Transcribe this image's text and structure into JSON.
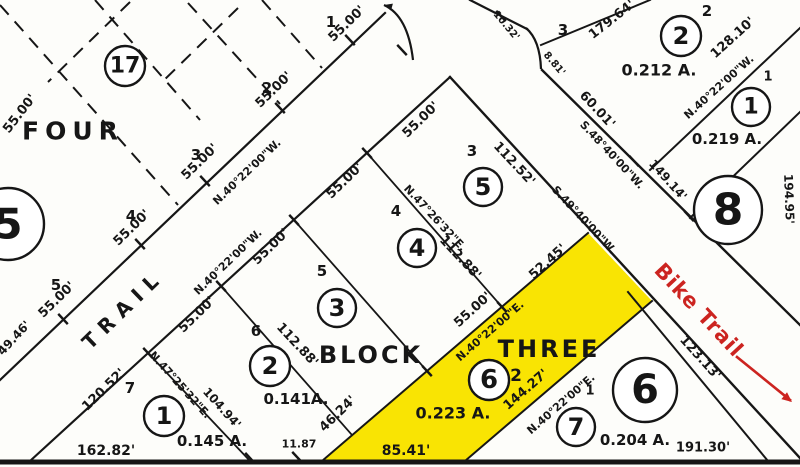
{
  "document": {
    "type": "plat-survey-map",
    "highlighted_parcel": "Lot 2 Block THREE (0.223 A.)"
  },
  "colors": {
    "ink": "#161616",
    "background": "#fdfdfa",
    "highlight_yellow": "#f9e403",
    "annotation_red": "#cc2420"
  },
  "map": {
    "labels": [
      {
        "text": "FOUR",
        "x": 73,
        "y": 131,
        "rot": 0,
        "size": 25,
        "spacing": 6,
        "name": "block-four-title"
      },
      {
        "text": "BLOCK",
        "x": 371,
        "y": 355,
        "rot": 0,
        "size": 24,
        "spacing": 3,
        "name": "block-three-title-block"
      },
      {
        "text": "THREE",
        "x": 549,
        "y": 349,
        "rot": 0,
        "size": 24,
        "spacing": 3,
        "name": "block-three-title-three"
      },
      {
        "text": "TRAIL",
        "x": 123,
        "y": 309,
        "rot": -44,
        "size": 20,
        "spacing": 8,
        "name": "trail-road-label"
      },
      {
        "text": "Bike Trail",
        "x": 699,
        "y": 310,
        "rot": 47,
        "size": 21,
        "spacing": 1,
        "color": "#cc2420",
        "name": "bike-trail-label"
      },
      {
        "text": "0.212 A.",
        "x": 659,
        "y": 70,
        "rot": 0,
        "size": 16
      },
      {
        "text": "0.219 A.",
        "x": 727,
        "y": 139,
        "rot": 0,
        "size": 15
      },
      {
        "text": "0.141A.",
        "x": 296,
        "y": 399,
        "rot": 0,
        "size": 15
      },
      {
        "text": "0.145 A.",
        "x": 212,
        "y": 441,
        "rot": 0,
        "size": 15
      },
      {
        "text": "0.223 A.",
        "x": 453,
        "y": 413,
        "rot": 0,
        "size": 16
      },
      {
        "text": "0.204 A.",
        "x": 635,
        "y": 440,
        "rot": 0,
        "size": 15
      },
      {
        "text": "49.46'",
        "x": 14,
        "y": 338,
        "rot": -47,
        "size": 12
      },
      {
        "text": "55.00'",
        "x": 57,
        "y": 300,
        "rot": -44,
        "size": 13
      },
      {
        "text": "55.00'",
        "x": 132,
        "y": 228,
        "rot": -44,
        "size": 13
      },
      {
        "text": "55.00'",
        "x": 200,
        "y": 162,
        "rot": -44,
        "size": 13
      },
      {
        "text": "55.00'",
        "x": 274,
        "y": 90,
        "rot": -44,
        "size": 13
      },
      {
        "text": "55.00'",
        "x": 347,
        "y": 24,
        "rot": -44,
        "size": 13
      },
      {
        "text": "55.00'",
        "x": 20,
        "y": 114,
        "rot": -52,
        "size": 13
      },
      {
        "text": "55.00'",
        "x": 197,
        "y": 315,
        "rot": -44,
        "size": 13
      },
      {
        "text": "55.00'",
        "x": 271,
        "y": 247,
        "rot": -44,
        "size": 13
      },
      {
        "text": "55.00'",
        "x": 345,
        "y": 181,
        "rot": -44,
        "size": 13
      },
      {
        "text": "55.00'",
        "x": 421,
        "y": 120,
        "rot": -44,
        "size": 13
      },
      {
        "text": "55.00'",
        "x": 473,
        "y": 310,
        "rot": -42,
        "size": 13
      },
      {
        "text": "52.45'",
        "x": 548,
        "y": 262,
        "rot": -42,
        "size": 13
      },
      {
        "text": "46.24'",
        "x": 338,
        "y": 414,
        "rot": -44,
        "size": 13
      },
      {
        "text": "120.52'",
        "x": 104,
        "y": 390,
        "rot": -44,
        "size": 13
      },
      {
        "text": "128.10'",
        "x": 733,
        "y": 38,
        "rot": -42,
        "size": 13
      },
      {
        "text": "179.64'",
        "x": 612,
        "y": 20,
        "rot": -38,
        "size": 13
      },
      {
        "text": "144.27'",
        "x": 526,
        "y": 390,
        "rot": -41,
        "size": 13
      },
      {
        "text": "162.82'",
        "x": 106,
        "y": 451,
        "rot": 0,
        "size": 14
      },
      {
        "text": "85.41'",
        "x": 406,
        "y": 451,
        "rot": 0,
        "size": 14
      },
      {
        "text": "11.87",
        "x": 299,
        "y": 444,
        "rot": 0,
        "size": 11
      },
      {
        "text": "191.30'",
        "x": 703,
        "y": 448,
        "rot": 0,
        "size": 13
      },
      {
        "text": "194.95'",
        "x": 789,
        "y": 199,
        "rot": 88,
        "size": 12
      },
      {
        "text": "112.52'",
        "x": 514,
        "y": 164,
        "rot": 47,
        "size": 13
      },
      {
        "text": "112.88'",
        "x": 460,
        "y": 258,
        "rot": 47,
        "size": 13
      },
      {
        "text": "112.88'",
        "x": 297,
        "y": 345,
        "rot": 47,
        "size": 13
      },
      {
        "text": "104.94'",
        "x": 222,
        "y": 408,
        "rot": 48,
        "size": 12
      },
      {
        "text": "123.13'",
        "x": 700,
        "y": 358,
        "rot": 48,
        "size": 13
      },
      {
        "text": "149.14'",
        "x": 668,
        "y": 180,
        "rot": 48,
        "size": 12
      },
      {
        "text": "60.01'",
        "x": 597,
        "y": 110,
        "rot": 47,
        "size": 13
      },
      {
        "text": "10.32'",
        "x": 506,
        "y": 26,
        "rot": 50,
        "size": 10
      },
      {
        "text": "8.81'",
        "x": 554,
        "y": 64,
        "rot": 50,
        "size": 10
      },
      {
        "text": "N.40°22'00\"W.",
        "x": 247,
        "y": 172,
        "rot": -44,
        "size": 11
      },
      {
        "text": "N.40°22'00\"W.",
        "x": 228,
        "y": 262,
        "rot": -44,
        "size": 11
      },
      {
        "text": "N.40°22'00\"W.",
        "x": 719,
        "y": 87,
        "rot": -42,
        "size": 11
      },
      {
        "text": "N.40°22'00\"E.",
        "x": 490,
        "y": 331,
        "rot": -41,
        "size": 11
      },
      {
        "text": "N.40°22'00\"E.",
        "x": 561,
        "y": 404,
        "rot": -41,
        "size": 11
      },
      {
        "text": "N.47°25'32\"E.",
        "x": 180,
        "y": 385,
        "rot": 48,
        "size": 11
      },
      {
        "text": "N.47°26'32\"E.",
        "x": 435,
        "y": 218,
        "rot": 47,
        "size": 11
      },
      {
        "text": "S.48°40'00\"W.",
        "x": 612,
        "y": 155,
        "rot": 47,
        "size": 11
      },
      {
        "text": "S.49°40'00\"W.",
        "x": 584,
        "y": 220,
        "rot": 47,
        "size": 11
      },
      {
        "text": "1",
        "x": 331,
        "y": 22,
        "rot": 0,
        "size": 15
      },
      {
        "text": "2",
        "x": 267,
        "y": 88,
        "rot": 0,
        "size": 15
      },
      {
        "text": "3",
        "x": 196,
        "y": 155,
        "rot": 0,
        "size": 15
      },
      {
        "text": "4",
        "x": 131,
        "y": 216,
        "rot": 0,
        "size": 15
      },
      {
        "text": "5",
        "x": 56,
        "y": 285,
        "rot": 0,
        "size": 15
      },
      {
        "text": "3",
        "x": 563,
        "y": 30,
        "rot": 0,
        "size": 15
      },
      {
        "text": "2",
        "x": 707,
        "y": 11,
        "rot": 0,
        "size": 15
      },
      {
        "text": "1",
        "x": 768,
        "y": 77,
        "rot": 0,
        "size": 13
      },
      {
        "text": "3",
        "x": 472,
        "y": 151,
        "rot": 0,
        "size": 15
      },
      {
        "text": "4",
        "x": 396,
        "y": 211,
        "rot": 0,
        "size": 15
      },
      {
        "text": "5",
        "x": 322,
        "y": 271,
        "rot": 0,
        "size": 15
      },
      {
        "text": "6",
        "x": 256,
        "y": 331,
        "rot": 0,
        "size": 15
      },
      {
        "text": "7",
        "x": 130,
        "y": 388,
        "rot": 0,
        "size": 15
      },
      {
        "text": "2",
        "x": 516,
        "y": 376,
        "rot": 0,
        "size": 17
      },
      {
        "text": "1",
        "x": 590,
        "y": 391,
        "rot": 0,
        "size": 13
      }
    ],
    "circles": [
      {
        "n": "17",
        "x": 125,
        "y": 66,
        "r": 20,
        "size": 22,
        "name": "block-17-marker"
      },
      {
        "n": "5",
        "x": 8,
        "y": 224,
        "r": 36,
        "size": 42,
        "name": "block-5-marker"
      },
      {
        "n": "8",
        "x": 728,
        "y": 210,
        "r": 34,
        "size": 44,
        "name": "block-8-marker"
      },
      {
        "n": "6",
        "x": 645,
        "y": 390,
        "r": 32,
        "size": 40,
        "name": "block-6-marker"
      },
      {
        "n": "2",
        "x": 681,
        "y": 36,
        "r": 20,
        "size": 24,
        "name": "lot-marker"
      },
      {
        "n": "1",
        "x": 751,
        "y": 107,
        "r": 19,
        "size": 22,
        "name": "lot-marker"
      },
      {
        "n": "1",
        "x": 164,
        "y": 416,
        "r": 20,
        "size": 24,
        "name": "lot-marker"
      },
      {
        "n": "2",
        "x": 270,
        "y": 366,
        "r": 20,
        "size": 24,
        "name": "lot-marker"
      },
      {
        "n": "3",
        "x": 337,
        "y": 308,
        "r": 19,
        "size": 24,
        "name": "lot-marker"
      },
      {
        "n": "4",
        "x": 417,
        "y": 248,
        "r": 19,
        "size": 24,
        "name": "lot-marker"
      },
      {
        "n": "5",
        "x": 483,
        "y": 187,
        "r": 19,
        "size": 24,
        "name": "lot-marker"
      },
      {
        "n": "6",
        "x": 489,
        "y": 380,
        "r": 20,
        "size": 26,
        "name": "highlighted-lot-marker"
      },
      {
        "n": "7",
        "x": 576,
        "y": 427,
        "r": 19,
        "size": 24,
        "name": "lot-marker"
      }
    ],
    "solid_lines": [
      {
        "x1": 0,
        "y1": 380,
        "x2": 385,
        "y2": 13,
        "w": 2.2,
        "name": "trail-nw-edge"
      },
      {
        "x1": 30,
        "y1": 461,
        "x2": 450,
        "y2": 77,
        "w": 2.2,
        "name": "trail-se-edge"
      },
      {
        "x1": 450,
        "y1": 77,
        "x2": 800,
        "y2": 458,
        "w": 2.4,
        "name": "bike-road-sw-edge"
      },
      {
        "x1": 542,
        "y1": 70,
        "x2": 800,
        "y2": 325,
        "w": 2.4,
        "name": "bike-road-ne-edge"
      },
      {
        "x1": 470,
        "y1": 0,
        "x2": 527,
        "y2": 29,
        "w": 2.2,
        "name": "road-junction-line"
      },
      {
        "x1": 541,
        "y1": 45,
        "x2": 650,
        "y2": 0,
        "w": 2,
        "name": "line-179"
      },
      {
        "x1": 650,
        "y1": 170,
        "x2": 800,
        "y2": 28,
        "w": 2,
        "name": "right-boundary-line"
      },
      {
        "x1": 690,
        "y1": 218,
        "x2": 800,
        "y2": 112,
        "w": 2,
        "name": "block-219-line"
      },
      {
        "x1": 628,
        "y1": 292,
        "x2": 768,
        "y2": 461,
        "w": 2,
        "name": "line-123"
      },
      {
        "x1": 148,
        "y1": 353,
        "x2": 250,
        "y2": 461,
        "w": 1.8,
        "name": "lot-7-6-line"
      },
      {
        "x1": 221,
        "y1": 286,
        "x2": 352,
        "y2": 435,
        "w": 1.8,
        "name": "lot-6-5-line"
      },
      {
        "x1": 294,
        "y1": 220,
        "x2": 427,
        "y2": 371,
        "w": 1.8,
        "name": "lot-5-4-line"
      },
      {
        "x1": 367,
        "y1": 153,
        "x2": 502,
        "y2": 307,
        "w": 1.8,
        "name": "lot-4-3-line"
      },
      {
        "x1": 322,
        "y1": 461,
        "x2": 588,
        "y2": 233,
        "w": 2,
        "name": "yellow-lot-nw-edge"
      },
      {
        "x1": 465,
        "y1": 461,
        "x2": 652,
        "y2": 301,
        "w": 2,
        "name": "yellow-lot-se-edge"
      },
      {
        "x1": 0,
        "y1": 462,
        "x2": 800,
        "y2": 462,
        "w": 5,
        "name": "bottom-boundary"
      },
      {
        "x1": 737,
        "y1": 357,
        "x2": 790,
        "y2": 400,
        "w": 2.6,
        "color": "#cc2420",
        "name": "bike-trail-arrow-shaft"
      }
    ],
    "dashed_lines": [
      {
        "x1": 0,
        "y1": 5,
        "x2": 178,
        "y2": 205
      },
      {
        "x1": 95,
        "y1": 0,
        "x2": 200,
        "y2": 120
      },
      {
        "x1": 188,
        "y1": 3,
        "x2": 280,
        "y2": 104
      },
      {
        "x1": 262,
        "y1": 0,
        "x2": 322,
        "y2": 68
      },
      {
        "x1": 130,
        "y1": 2,
        "x2": 48,
        "y2": 82
      },
      {
        "x1": 238,
        "y1": 8,
        "x2": 160,
        "y2": 84
      }
    ],
    "paths": [
      {
        "d": "M 413,60 Q 408,16 384,5",
        "w": 2.2,
        "name": "trail-top-curve"
      },
      {
        "d": "M 526,28 Q 540,40 541,69",
        "w": 2.2,
        "name": "junction-curve"
      }
    ],
    "ticks": [
      {
        "x": 63,
        "y": 319
      },
      {
        "x": 140,
        "y": 244
      },
      {
        "x": 205,
        "y": 181
      },
      {
        "x": 280,
        "y": 108
      },
      {
        "x": 350,
        "y": 40
      },
      {
        "x": 148,
        "y": 353
      },
      {
        "x": 221,
        "y": 286
      },
      {
        "x": 294,
        "y": 220
      },
      {
        "x": 367,
        "y": 153
      },
      {
        "x": 634,
        "y": 161
      },
      {
        "x": 689,
        "y": 216
      },
      {
        "x": 501,
        "y": 16
      },
      {
        "x": 402,
        "y": 50
      },
      {
        "x": 427,
        "y": 371
      },
      {
        "x": 502,
        "y": 307
      },
      {
        "x": 250,
        "y": 458
      },
      {
        "x": 297,
        "y": 457
      }
    ],
    "arrow_heads": [
      {
        "x": 384,
        "y": 5,
        "angle": 195,
        "size": 9,
        "color": "#161616",
        "name": "trail-curve-arrowhead"
      },
      {
        "x": 792,
        "y": 402,
        "angle": 39,
        "size": 11,
        "color": "#cc2420",
        "name": "bike-trail-arrowhead"
      }
    ],
    "highlight_polygon": {
      "points": "322,461 588,233 652,301 465,461",
      "name": "highlighted-lot-2"
    }
  }
}
